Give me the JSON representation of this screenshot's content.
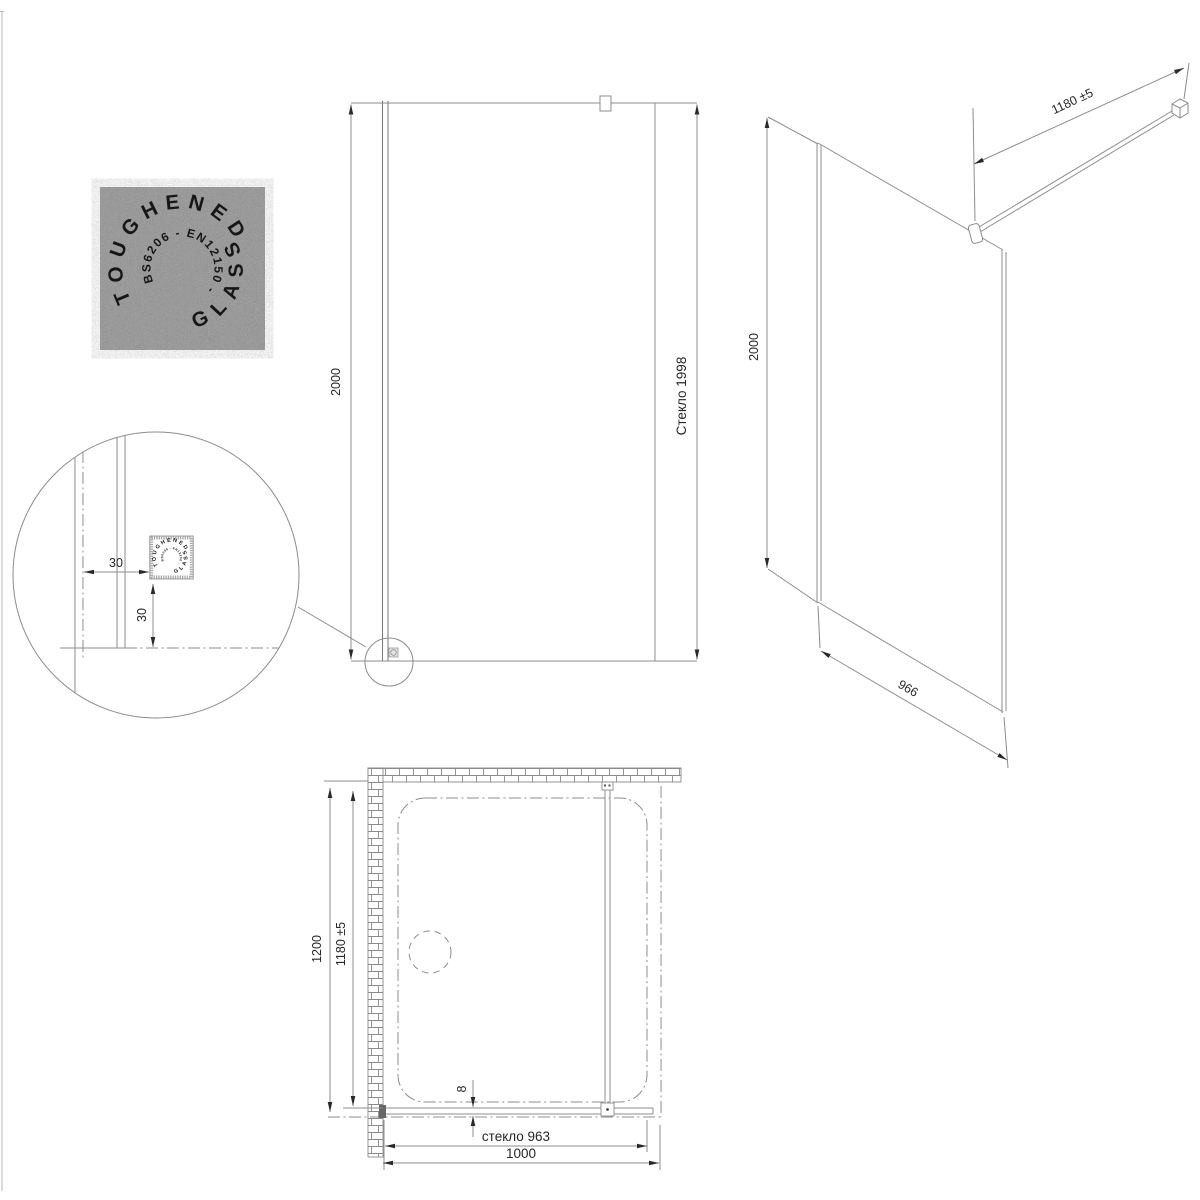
{
  "stamp": {
    "outer_text_top": "TOUGHENED",
    "outer_text_bottom": "GLASS",
    "inner_text": "BS6206 - EN12150 -"
  },
  "front_view": {
    "height_label": "2000",
    "glass_height_label": "Стекло 1998"
  },
  "detail_view": {
    "offset_horizontal_label": "30",
    "offset_vertical_label": "30"
  },
  "iso_view": {
    "height_label": "2000",
    "bar_length_label": "1180 ±5",
    "width_label": "966"
  },
  "plan_view": {
    "depth_label": "1200",
    "glass_depth_label": "1180 ±5",
    "glass_thickness_label": "8",
    "glass_width_label": "стекло 963",
    "opening_width_label": "1000"
  },
  "colors": {
    "line": "#8c8c8c",
    "arrow_and_text": "#2a2a2a",
    "brick": "#8a8a8a",
    "stamp_background": "#9b9b9b"
  }
}
